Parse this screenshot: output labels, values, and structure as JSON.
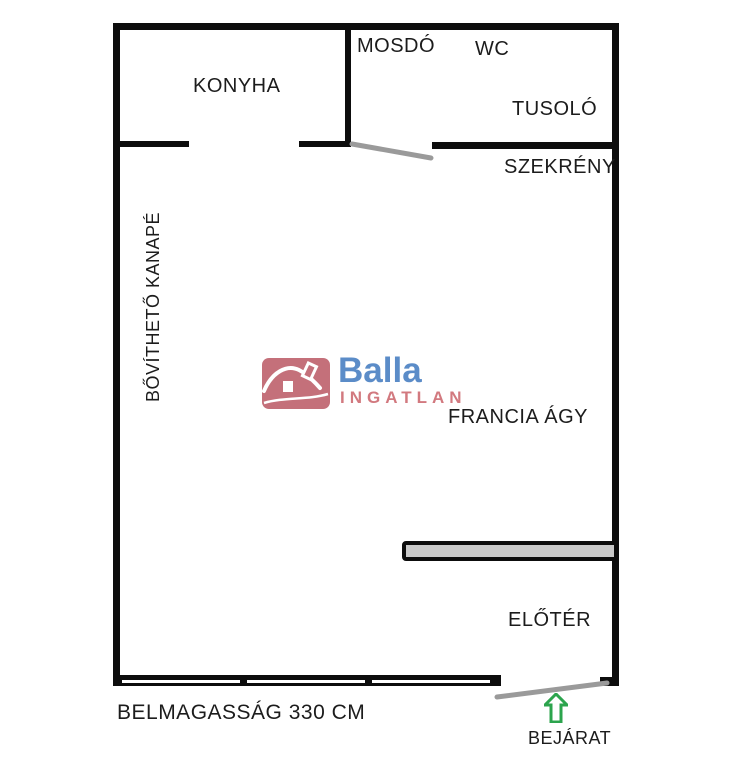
{
  "colors": {
    "background": "#ffffff",
    "wall": "#0d0d0d",
    "door_swing": "#9a9a9a",
    "counter_fill": "#c9c9c9",
    "arrow_green": "#2ca44d",
    "logo_red": "#c4707a",
    "logo_blue": "#5b8cc8",
    "logo_pink": "#d2797f",
    "label_text": "#1c1c1c"
  },
  "floorplan": {
    "rooms": {
      "konyha": "KONYHA",
      "mosdo": "MOSDÓ",
      "wc": "WC",
      "tusolo": "TUSOLÓ",
      "szekreny": "SZEKRÉNY",
      "kanape": "BŐVÍTHETŐ KANAPÉ",
      "francia_agy": "FRANCIA ÁGY",
      "eloter": "ELŐTÉR"
    },
    "annotations": {
      "ceiling_height": "BELMAGASSÁG 330 CM",
      "entrance": "BEJÁRAT"
    }
  },
  "logo": {
    "brand": "Balla",
    "subtitle": "INGATLAN"
  }
}
